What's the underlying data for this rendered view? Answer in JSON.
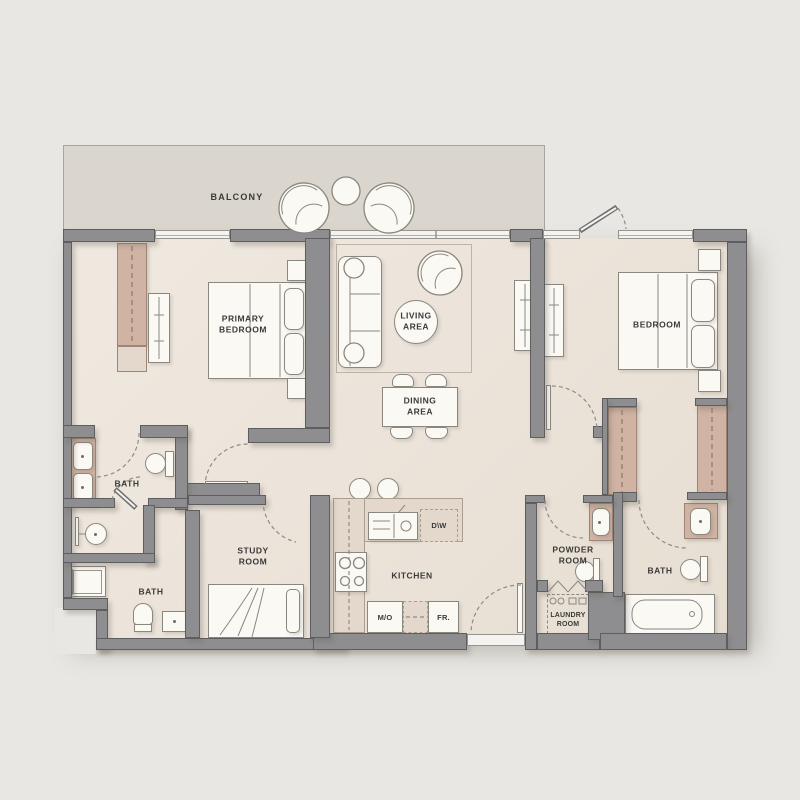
{
  "plan": {
    "type": "apartment-floor-plan",
    "labels": {
      "balcony": "BALCONY",
      "primary_bedroom": "PRIMARY\nBEDROOM",
      "living_area": "LIVING\nAREA",
      "bedroom": "BEDROOM",
      "dining_area": "DINING\nAREA",
      "bath_ensuite": "BATH",
      "bath_lower": "BATH",
      "bath_right": "BATH",
      "study_room": "STUDY\nROOM",
      "kitchen": "KITCHEN",
      "powder_room": "POWDER\nROOM",
      "laundry_room": "LAUNDRY\nROOM",
      "dishwasher": "D\\W",
      "microwave": "M/O",
      "fridge": "FR."
    },
    "colors": {
      "bg": "#e9e7e3",
      "balcony": "#dad5cd",
      "floor": "#ece4da",
      "wall": "#8e8e90",
      "wall_edge": "#5e5e60",
      "tan": "#d0b3a3",
      "tan_edge": "#9d8677",
      "counter": "#e3d8cb",
      "counter_edge": "#a89f90",
      "white": "#fbf9f4",
      "outline": "#8a877f",
      "window": "#f5f3ef",
      "text": "#3a3a3a"
    }
  }
}
